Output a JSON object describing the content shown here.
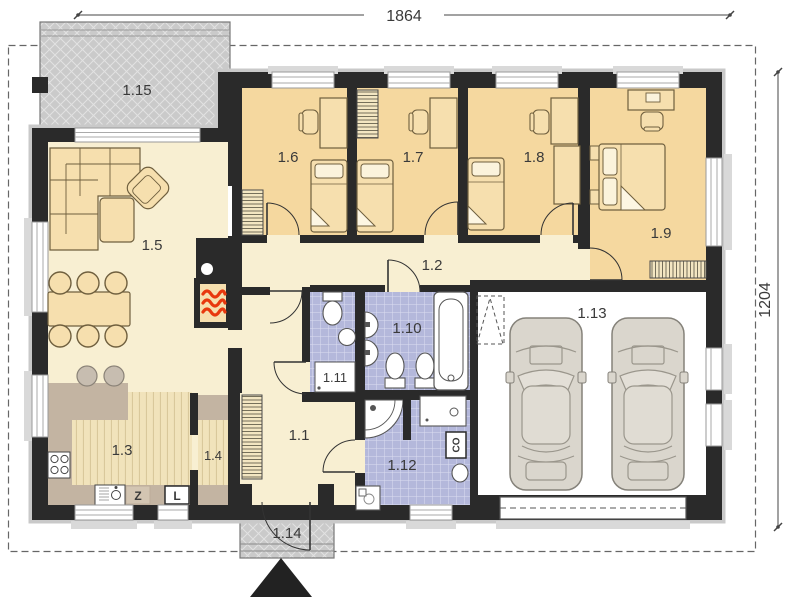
{
  "dimensions": {
    "width_label": "1864",
    "height_label": "1204"
  },
  "rooms": [
    {
      "label": "1.1"
    },
    {
      "label": "1.2"
    },
    {
      "label": "1.3"
    },
    {
      "label": "1.4"
    },
    {
      "label": "1.5"
    },
    {
      "label": "1.6"
    },
    {
      "label": "1.7"
    },
    {
      "label": "1.8"
    },
    {
      "label": "1.9"
    },
    {
      "label": "1.10"
    },
    {
      "label": "1.11"
    },
    {
      "label": "1.12"
    },
    {
      "label": "1.13"
    },
    {
      "label": "1.14"
    },
    {
      "label": "1.15"
    }
  ],
  "appliance_labels": {
    "z_label": "Z",
    "l_label": "L",
    "co_label": "CO"
  },
  "colors": {
    "wall": "#2A2A2A",
    "living_floor": "#F8EFD2",
    "bedroom_floor": "#F5D89F",
    "bathroom_tile": "#B4B8DB",
    "terrace_gray": "#CACACA",
    "kitchen_counter": "#C3B4A2",
    "furniture_cream": "#F6DFAE",
    "flame_red": "#E8380D",
    "car_body": "#DAD6CD"
  }
}
